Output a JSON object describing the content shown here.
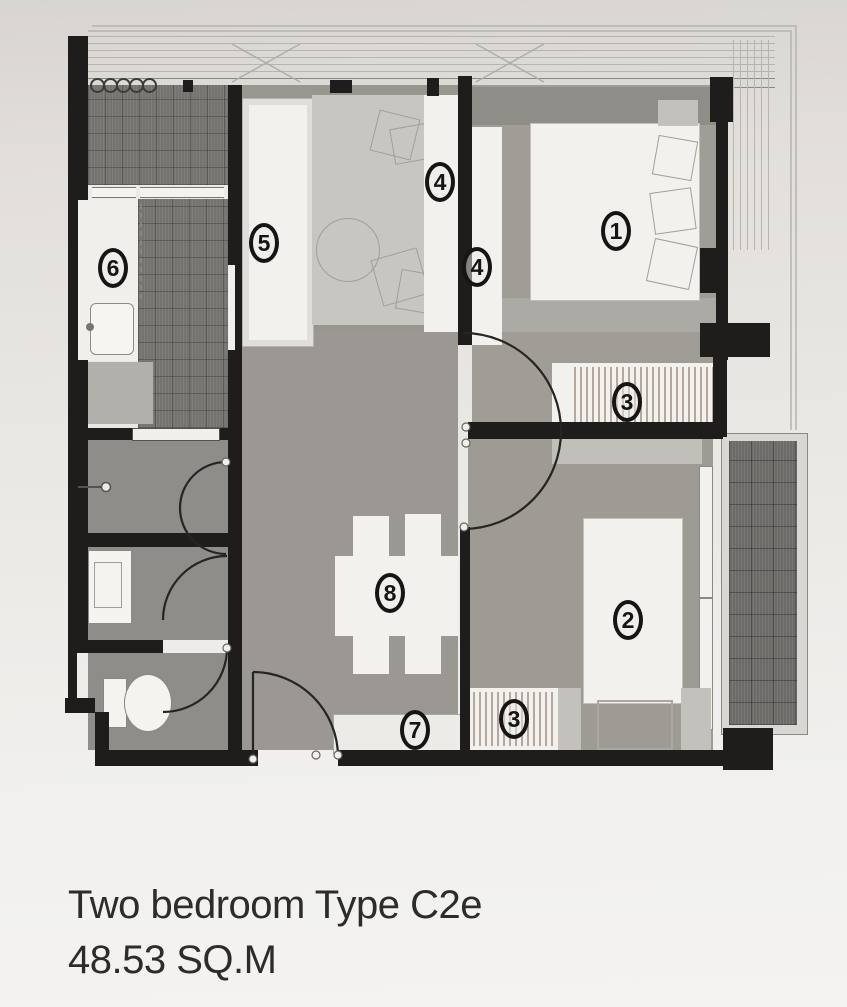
{
  "caption": {
    "line1": "Two bedroom  Type C2e",
    "line2": "48.53 SQ.M"
  },
  "markers": {
    "m1": "1",
    "m2": "2",
    "m3a": "3",
    "m3b": "3",
    "m4a": "4",
    "m4b": "4",
    "m5": "5",
    "m6": "6",
    "m7": "7",
    "m8": "8"
  },
  "colors": {
    "wall": "#1e1d1b",
    "paper": "#eae8e4",
    "floor_gray": "#9b9893",
    "floor_light_rug": "#c8c6c0",
    "furniture_white": "#f2f1ed",
    "dark_hatch": "#74736f",
    "marker_ink": "#161513",
    "caption_ink": "#2d2c2a"
  }
}
